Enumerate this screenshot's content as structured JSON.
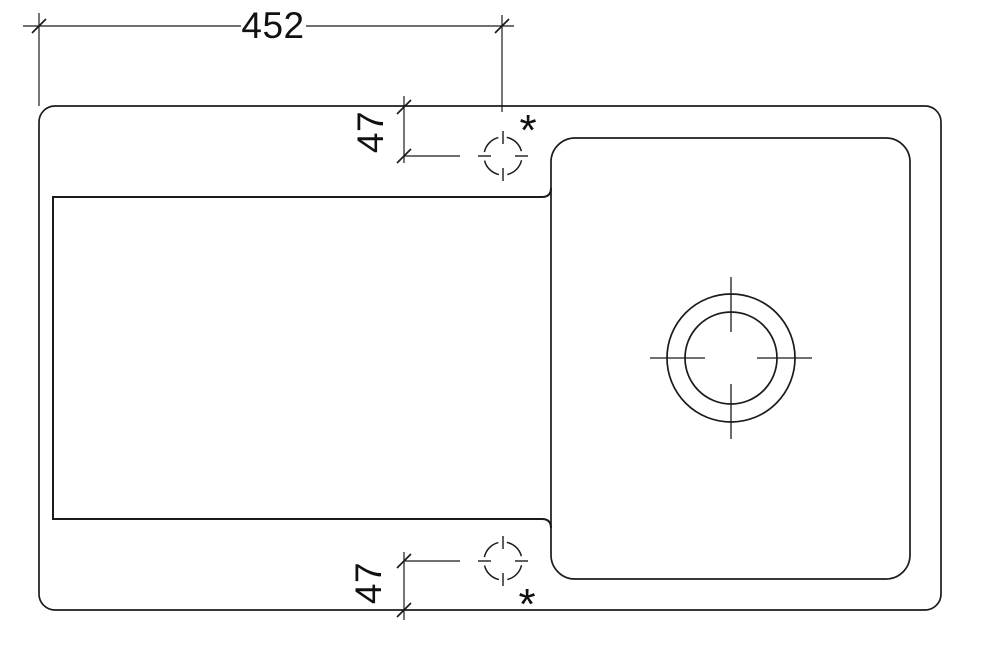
{
  "drawing": {
    "type": "technical-plan-drawing",
    "subject": "kitchen sink with drainboard, basin, drain and tap holes",
    "colors": {
      "background": "#ffffff",
      "line": "#1b1b1b",
      "text": "#111111"
    },
    "dimensions": {
      "overall_width": {
        "label": "452"
      },
      "tap_offset_top": {
        "label": "47"
      },
      "tap_offset_bottom": {
        "label": "47"
      }
    },
    "markers": {
      "tap_hole_top": {
        "label": "*"
      },
      "tap_hole_bottom": {
        "label": "*"
      }
    }
  }
}
